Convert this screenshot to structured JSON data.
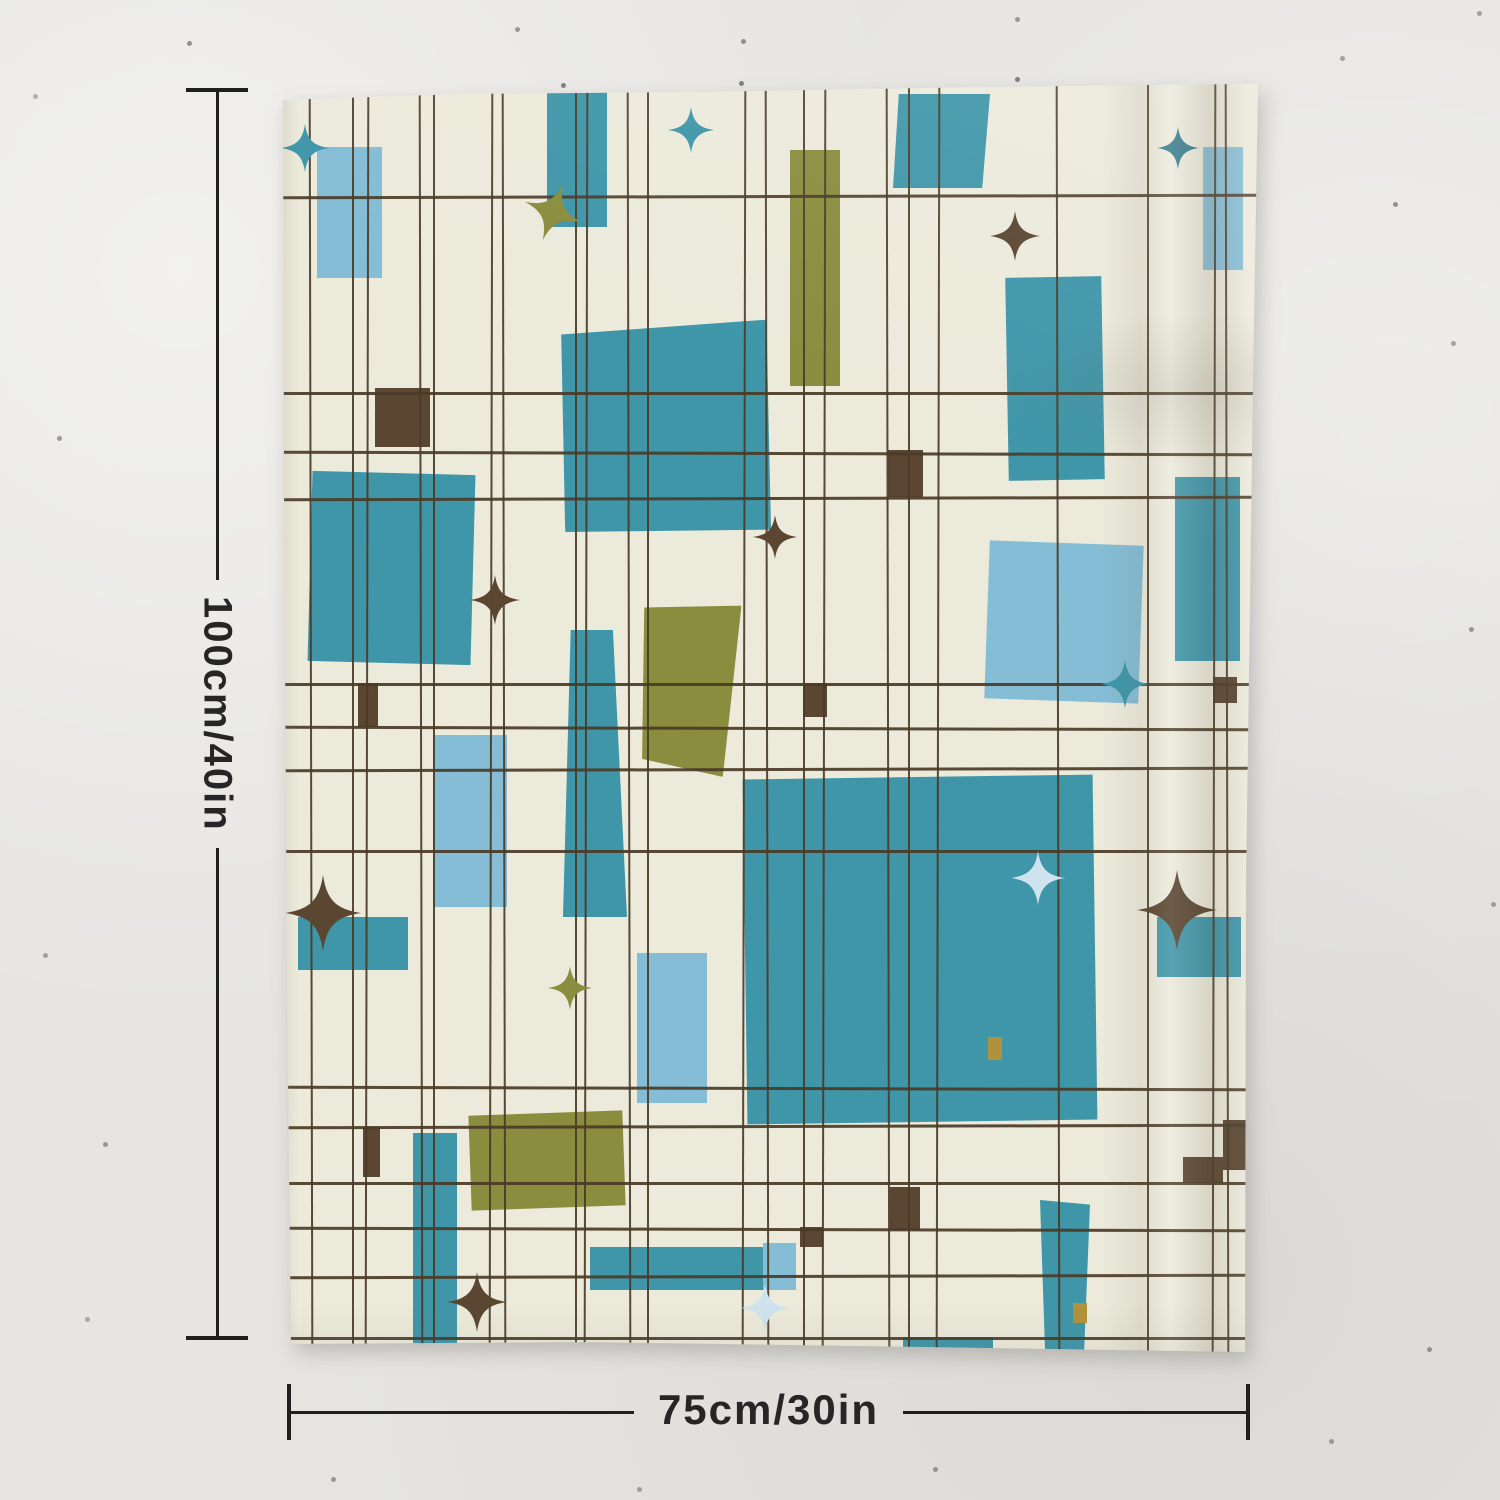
{
  "scene": {
    "type": "product photo",
    "subject": "Mid-century modern abstract grid tapestry hanging on a textured wall"
  },
  "dimensions": {
    "height_label": "100cm/40in",
    "width_label": "75cm/30in"
  },
  "palette": {
    "wall": "#e6e5e2",
    "fabric": "#eceadb",
    "teal": "#3f96a9",
    "light_blue": "#85bdd6",
    "pale_blue": "#cfe3ee",
    "olive": "#8a8c3e",
    "brown": "#5a4631",
    "dark_teal": "#2d7486",
    "mustard": "#b0913c",
    "line": "#4a3b27",
    "annotation": "#222222"
  },
  "artwork": {
    "style": "irregular plaid grid with floating rectangles and four-point starbursts",
    "grid": {
      "vertical_x": [
        27,
        69,
        83,
        137,
        150,
        207,
        220,
        292,
        302,
        345,
        364,
        460,
        483,
        520,
        540,
        604,
        625,
        654,
        774,
        864,
        930,
        943
      ],
      "horizontal_y": [
        111,
        308,
        368,
        413,
        599,
        643,
        684,
        766,
        1003,
        1041,
        1098,
        1144,
        1191,
        1253
      ]
    },
    "rects": [
      {
        "x": 34,
        "y": 63,
        "w": 65,
        "h": 131,
        "c": "light_blue"
      },
      {
        "x": 264,
        "y": 8,
        "w": 60,
        "h": 135,
        "c": "teal"
      },
      {
        "x": 610,
        "y": 10,
        "w": 97,
        "h": 94,
        "c": "teal",
        "clip": "polygon(6% 0,100% 0,92% 100%,0 100%)"
      },
      {
        "x": 920,
        "y": 63,
        "w": 40,
        "h": 123,
        "c": "light_blue"
      },
      {
        "x": 507,
        "y": 66,
        "w": 50,
        "h": 236,
        "c": "olive"
      },
      {
        "x": 724,
        "y": 193,
        "w": 96,
        "h": 203,
        "c": "teal",
        "rot": -1
      },
      {
        "x": 277,
        "y": 241,
        "w": 212,
        "h": 210,
        "c": "teal",
        "rot": -3,
        "clip": "polygon(3% 2%,100% 0,97% 100%,0 96%)"
      },
      {
        "x": 27,
        "y": 389,
        "w": 163,
        "h": 190,
        "c": "teal",
        "rot": 1.5
      },
      {
        "x": 92,
        "y": 304,
        "w": 55,
        "h": 59,
        "c": "brown"
      },
      {
        "x": 605,
        "y": 366,
        "w": 35,
        "h": 47,
        "c": "brown"
      },
      {
        "x": 892,
        "y": 393,
        "w": 65,
        "h": 184,
        "c": "teal"
      },
      {
        "x": 704,
        "y": 459,
        "w": 154,
        "h": 158,
        "c": "light_blue",
        "rot": 2
      },
      {
        "x": 280,
        "y": 546,
        "w": 64,
        "h": 287,
        "c": "teal",
        "clip": "polygon(12% 0,78% 0,100% 100%,0 100%)"
      },
      {
        "x": 357,
        "y": 519,
        "w": 97,
        "h": 172,
        "c": "olive",
        "rot": 3,
        "clip": "polygon(0 4%,100% 0,90% 100%,6% 92%)"
      },
      {
        "x": 150,
        "y": 651,
        "w": 74,
        "h": 172,
        "c": "light_blue"
      },
      {
        "x": 75,
        "y": 599,
        "w": 20,
        "h": 44,
        "c": "brown"
      },
      {
        "x": 520,
        "y": 599,
        "w": 24,
        "h": 34,
        "c": "brown"
      },
      {
        "x": 930,
        "y": 593,
        "w": 24,
        "h": 26,
        "c": "brown"
      },
      {
        "x": 15,
        "y": 833,
        "w": 110,
        "h": 53,
        "c": "teal"
      },
      {
        "x": 354,
        "y": 869,
        "w": 70,
        "h": 150,
        "c": "light_blue"
      },
      {
        "x": 462,
        "y": 693,
        "w": 350,
        "h": 345,
        "c": "teal",
        "rot": -0.8
      },
      {
        "x": 874,
        "y": 833,
        "w": 84,
        "h": 60,
        "c": "teal"
      },
      {
        "x": 187,
        "y": 1029,
        "w": 154,
        "h": 95,
        "c": "olive",
        "rot": -2
      },
      {
        "x": 80,
        "y": 1043,
        "w": 17,
        "h": 50,
        "c": "brown"
      },
      {
        "x": 130,
        "y": 1049,
        "w": 44,
        "h": 215,
        "c": "teal"
      },
      {
        "x": 307,
        "y": 1163,
        "w": 174,
        "h": 43,
        "c": "teal"
      },
      {
        "x": 480,
        "y": 1159,
        "w": 33,
        "h": 47,
        "c": "light_blue"
      },
      {
        "x": 940,
        "y": 1036,
        "w": 24,
        "h": 50,
        "c": "brown"
      },
      {
        "x": 900,
        "y": 1073,
        "w": 40,
        "h": 26,
        "c": "brown"
      },
      {
        "x": 607,
        "y": 1103,
        "w": 30,
        "h": 43,
        "c": "brown"
      },
      {
        "x": 517,
        "y": 1143,
        "w": 23,
        "h": 20,
        "c": "brown"
      },
      {
        "x": 757,
        "y": 1116,
        "w": 50,
        "h": 154,
        "c": "teal",
        "clip": "polygon(0 0,100% 3%,88% 100%,10% 97%)"
      },
      {
        "x": 620,
        "y": 1253,
        "w": 90,
        "h": 16,
        "c": "teal"
      },
      {
        "x": 705,
        "y": 953,
        "w": 14,
        "h": 23,
        "c": "mustard"
      },
      {
        "x": 790,
        "y": 1219,
        "w": 14,
        "h": 20,
        "c": "mustard"
      }
    ],
    "stars": [
      {
        "cx": 22,
        "cy": 64,
        "s": 48,
        "c": "teal"
      },
      {
        "cx": 408,
        "cy": 46,
        "s": 46,
        "c": "teal"
      },
      {
        "cx": 270,
        "cy": 128,
        "s": 60,
        "c": "olive",
        "rot": 20
      },
      {
        "cx": 732,
        "cy": 152,
        "s": 50,
        "c": "brown"
      },
      {
        "cx": 895,
        "cy": 64,
        "s": 42,
        "c": "dark_teal"
      },
      {
        "cx": 212,
        "cy": 516,
        "s": 50,
        "c": "brown"
      },
      {
        "cx": 492,
        "cy": 453,
        "s": 44,
        "c": "brown"
      },
      {
        "cx": 842,
        "cy": 600,
        "s": 48,
        "c": "teal"
      },
      {
        "cx": 40,
        "cy": 829,
        "s": 76,
        "c": "brown"
      },
      {
        "cx": 287,
        "cy": 904,
        "s": 44,
        "c": "olive"
      },
      {
        "cx": 755,
        "cy": 794,
        "s": 54,
        "c": "pale_blue"
      },
      {
        "cx": 894,
        "cy": 826,
        "s": 80,
        "c": "brown"
      },
      {
        "cx": 194,
        "cy": 1218,
        "s": 60,
        "c": "brown"
      },
      {
        "cx": 482,
        "cy": 1224,
        "s": 48,
        "c": "pale_blue"
      }
    ]
  }
}
